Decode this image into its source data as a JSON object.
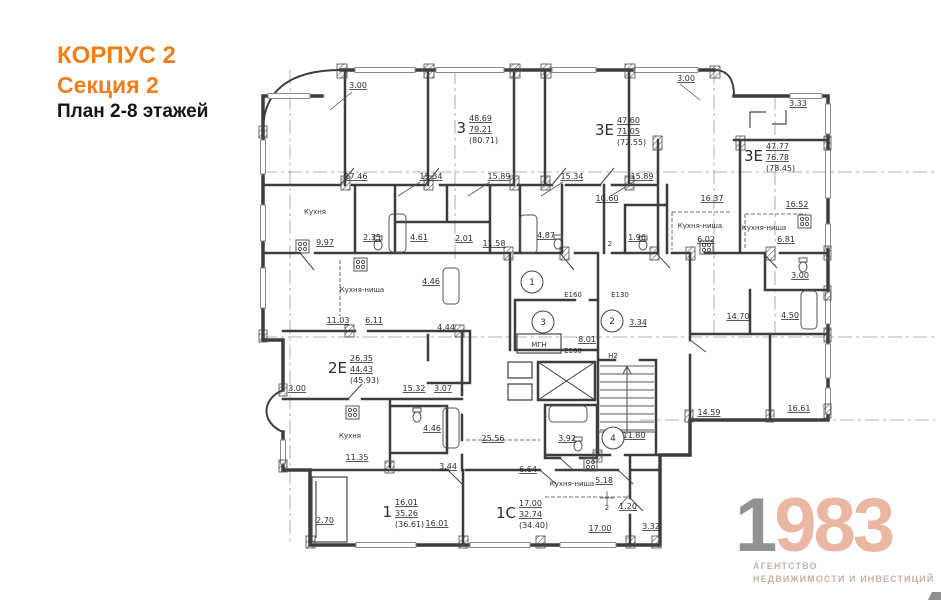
{
  "header": {
    "building": "КОРПУС 2",
    "section": "Секция 2",
    "plan_title": "План 2-8 этажей"
  },
  "logo": {
    "digit_gray": "1",
    "digits_accent": "983",
    "tagline_line1": "АГЕНТСТВО",
    "tagline_line2": "НЕДВИЖИМОСТИ И ИНВЕСТИЦИЙ"
  },
  "colors": {
    "accent_orange": "#ef7f1b",
    "logo_gray": "#929292",
    "logo_peach": "#e9b7a2",
    "wall": "#3d3d3d",
    "dim_text": "#2e2e2e"
  },
  "plan": {
    "apartments": [
      {
        "type": "3",
        "areas": [
          "48.69",
          "79.21",
          "(80.71)"
        ],
        "x": 466,
        "y": 128
      },
      {
        "type": "3Е",
        "areas": [
          "47.60",
          "71.05",
          "(72.55)"
        ],
        "x": 614,
        "y": 130
      },
      {
        "type": "3Е",
        "areas": [
          "47.77",
          "76.78",
          "(78.45)"
        ],
        "x": 763,
        "y": 156
      },
      {
        "type": "2Е",
        "areas": [
          "26.35",
          "44.43",
          "(45.93)"
        ],
        "x": 347,
        "y": 368
      },
      {
        "type": "1",
        "areas": [
          "16.01",
          "35.26",
          "(36.61)"
        ],
        "x": 392,
        "y": 512
      },
      {
        "type": "1С",
        "areas": [
          "17.00",
          "32.74",
          "(34.40)"
        ],
        "x": 516,
        "y": 513
      }
    ],
    "dimensions": [
      {
        "text": "3.00",
        "x": 358,
        "y": 88
      },
      {
        "text": "3.00",
        "x": 686,
        "y": 81
      },
      {
        "text": "3.33",
        "x": 798,
        "y": 106
      },
      {
        "text": "17.46",
        "x": 356,
        "y": 179
      },
      {
        "text": "15.34",
        "x": 431,
        "y": 179
      },
      {
        "text": "15.89",
        "x": 499,
        "y": 179
      },
      {
        "text": "15.34",
        "x": 572,
        "y": 179
      },
      {
        "text": "15.89",
        "x": 642,
        "y": 179
      },
      {
        "text": "10.60",
        "x": 607,
        "y": 201
      },
      {
        "text": "16.37",
        "x": 712,
        "y": 201
      },
      {
        "text": "16.52",
        "x": 797,
        "y": 207
      },
      {
        "text": "9.97",
        "x": 325,
        "y": 245
      },
      {
        "text": "2.35",
        "x": 372,
        "y": 240
      },
      {
        "text": "4.61",
        "x": 419,
        "y": 240
      },
      {
        "text": "2.01",
        "x": 464,
        "y": 241
      },
      {
        "text": "11.58",
        "x": 494,
        "y": 246
      },
      {
        "text": "4.87",
        "x": 546,
        "y": 238
      },
      {
        "text": "1.96",
        "x": 637,
        "y": 240
      },
      {
        "text": "6.02",
        "x": 706,
        "y": 242
      },
      {
        "text": "6.81",
        "x": 786,
        "y": 242
      },
      {
        "text": "3.00",
        "x": 800,
        "y": 278
      },
      {
        "text": "4.46",
        "x": 431,
        "y": 284
      },
      {
        "text": "11.03",
        "x": 338,
        "y": 323
      },
      {
        "text": "6.11",
        "x": 374,
        "y": 323
      },
      {
        "text": "4.44",
        "x": 446,
        "y": 330
      },
      {
        "text": "3.34",
        "x": 638,
        "y": 325
      },
      {
        "text": "8.01",
        "x": 587,
        "y": 342
      },
      {
        "text": "14.70",
        "x": 738,
        "y": 319
      },
      {
        "text": "4.50",
        "x": 790,
        "y": 318
      },
      {
        "text": "3.00",
        "x": 297,
        "y": 391
      },
      {
        "text": "15.32",
        "x": 414,
        "y": 391
      },
      {
        "text": "3.07",
        "x": 443,
        "y": 391
      },
      {
        "text": "11.80",
        "x": 634,
        "y": 438
      },
      {
        "text": "14.59",
        "x": 709,
        "y": 415
      },
      {
        "text": "16.61",
        "x": 799,
        "y": 411
      },
      {
        "text": "4.46",
        "x": 432,
        "y": 431
      },
      {
        "text": "25.56",
        "x": 493,
        "y": 441
      },
      {
        "text": "3.92",
        "x": 567,
        "y": 441
      },
      {
        "text": "11.35",
        "x": 357,
        "y": 460
      },
      {
        "text": "3.44",
        "x": 448,
        "y": 469
      },
      {
        "text": "6.64",
        "x": 528,
        "y": 472
      },
      {
        "text": "5.18",
        "x": 604,
        "y": 483
      },
      {
        "text": "1.20",
        "x": 628,
        "y": 509
      },
      {
        "text": "2.70",
        "x": 325,
        "y": 523
      },
      {
        "text": "16.01",
        "x": 437,
        "y": 526
      },
      {
        "text": "17.00",
        "x": 600,
        "y": 531
      },
      {
        "text": "3.32",
        "x": 651,
        "y": 529
      }
    ],
    "rooms": [
      {
        "text": "Кухня",
        "x": 315,
        "y": 214
      },
      {
        "text": "Кухня-ниша",
        "x": 362,
        "y": 292
      },
      {
        "text": "Кухня-ниша",
        "x": 700,
        "y": 228
      },
      {
        "text": "Кухня-ниша",
        "x": 764,
        "y": 230
      },
      {
        "text": "Кухня",
        "x": 350,
        "y": 438
      },
      {
        "text": "Кухня-ниша",
        "x": 572,
        "y": 486
      },
      {
        "text": "МГН",
        "x": 539,
        "y": 347
      },
      {
        "text": "Н2",
        "x": 613,
        "y": 358
      },
      {
        "text": "Е160",
        "x": 573,
        "y": 297
      },
      {
        "text": "Е130",
        "x": 620,
        "y": 297
      },
      {
        "text": "Е160",
        "x": 573,
        "y": 353
      },
      {
        "text": "2",
        "x": 610,
        "y": 246
      },
      {
        "text": "2",
        "x": 607,
        "y": 510
      }
    ],
    "axis_markers": [
      {
        "n": "1",
        "x": 532,
        "y": 282
      },
      {
        "n": "3",
        "x": 543,
        "y": 322
      },
      {
        "n": "2",
        "x": 612,
        "y": 321
      },
      {
        "n": "4",
        "x": 613,
        "y": 438
      }
    ]
  }
}
